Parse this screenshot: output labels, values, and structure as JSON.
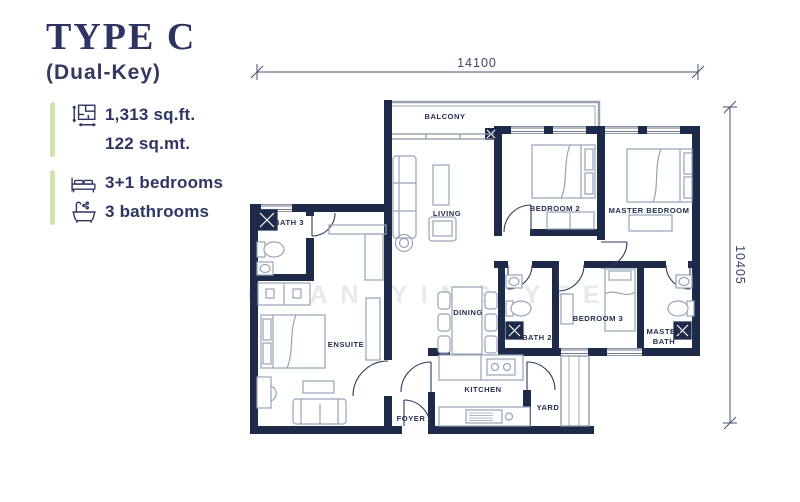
{
  "header": {
    "title": "TYPE C",
    "subtitle": "(Dual-Key)"
  },
  "specs": {
    "area_sqft": "1,313 sq.ft.",
    "area_sqmt": "122 sq.mt.",
    "bedrooms": "3+1 bedrooms",
    "bathrooms": "3 bathrooms"
  },
  "plan": {
    "dimension_top": "14100",
    "dimension_right": "10405",
    "watermark": "CHAN YING YEE",
    "rooms": {
      "balcony": "BALCONY",
      "living": "LIVING",
      "bedroom2": "BEDROOM 2",
      "master_bedroom": "MASTER BEDROOM",
      "bath3": "BATH 3",
      "ensuite": "ENSUITE",
      "dining": "DINING",
      "bath2": "BATH 2",
      "bedroom3": "BEDROOM 3",
      "master_bath_1": "MASTER",
      "master_bath_2": "BATH",
      "kitchen": "KITCHEN",
      "foyer": "FOYER",
      "yard": "YARD"
    }
  },
  "colors": {
    "wall": "#1e2a4a",
    "accent_green": "#cfe3aa",
    "text": "#2f3563",
    "furniture": "#97a3b6",
    "watermark": "#e6e9ee"
  }
}
